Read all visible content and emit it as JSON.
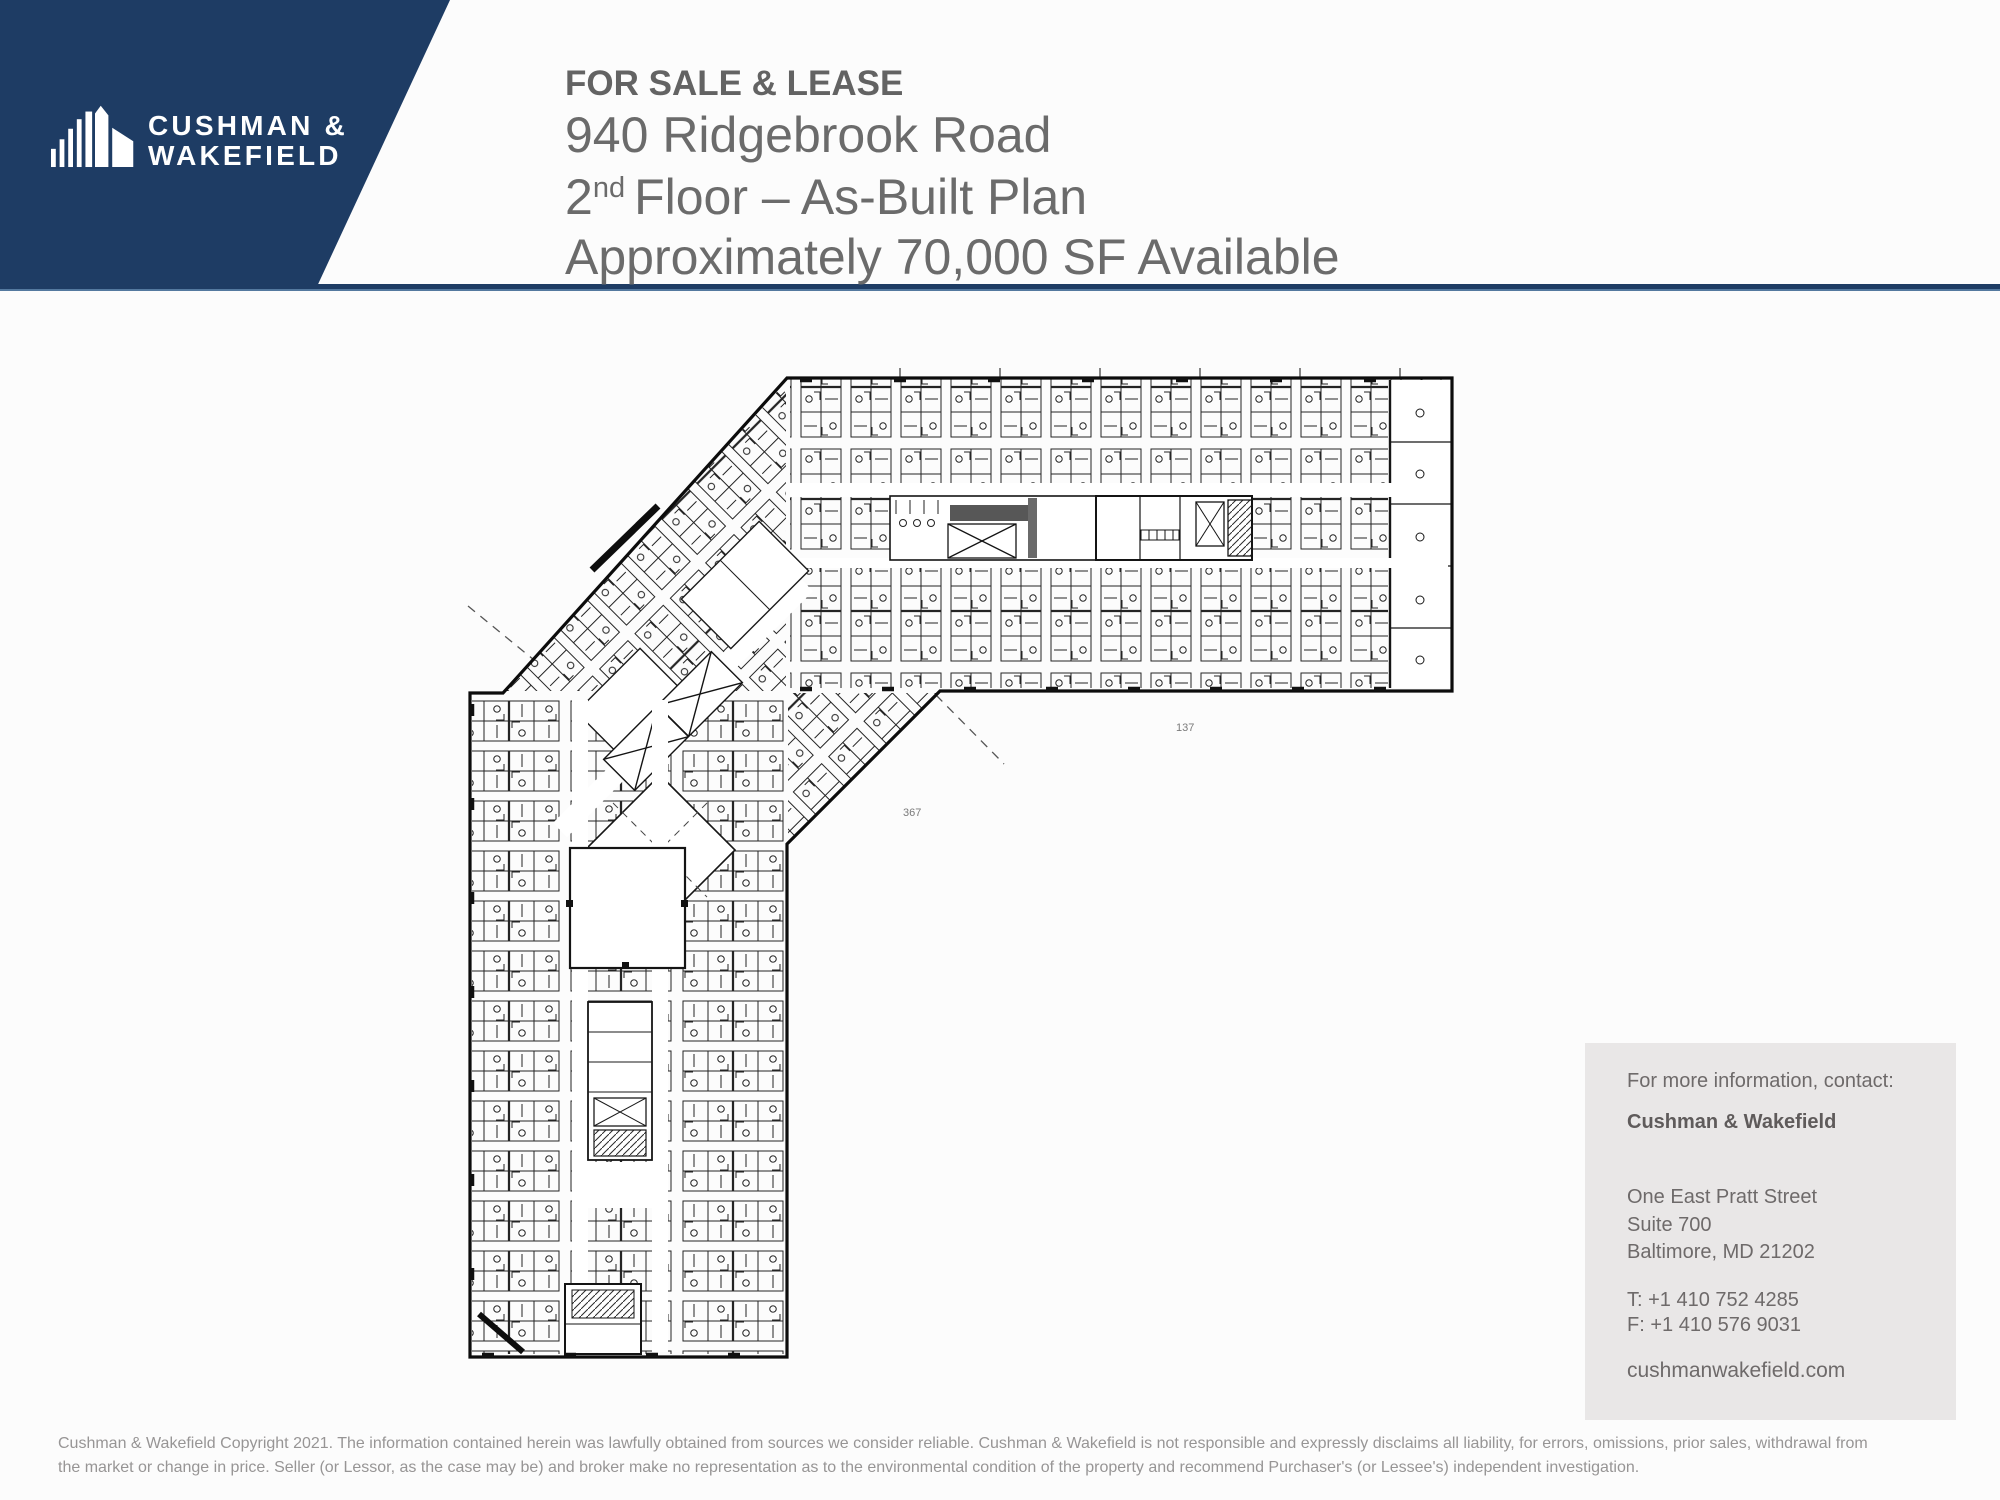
{
  "brand": {
    "navy": "#1e3c64",
    "logo_line1": "CUSHMAN &",
    "logo_line2": "WAKEFIELD"
  },
  "title": {
    "status": "FOR SALE & LEASE",
    "address": "940 Ridgebrook Road",
    "floor_number": "2",
    "floor_ordinal": "nd",
    "floor_text": "Floor – As-Built Plan",
    "availability": "Approximately 70,000 SF Available"
  },
  "plan": {
    "description": "2nd floor as-built architectural plan, L-shaped building with cubicles",
    "mark1": "137",
    "mark2": "367"
  },
  "contact": {
    "intro": "For more information, contact:",
    "company": "Cushman & Wakefield",
    "address_line1": "One East Pratt Street",
    "address_line2": "Suite 700",
    "address_line3": "Baltimore, MD 21202",
    "phone": "T: +1 410 752 4285",
    "fax": "F: +1 410 576 9031",
    "website": "cushmanwakefield.com"
  },
  "footer": {
    "line1": "Cushman & Wakefield Copyright 2021. The information contained herein was lawfully obtained from sources we consider reliable. Cushman & Wakefield is not responsible and expressly disclaims all liability, for errors, omissions, prior sales,  withdrawal from",
    "line2": "the market or change in price. Seller (or Lessor, as the case may be) and broker make no representation as to the environmental condition of the property and recommend Purchaser's (or Lessee's) independent investigation."
  }
}
